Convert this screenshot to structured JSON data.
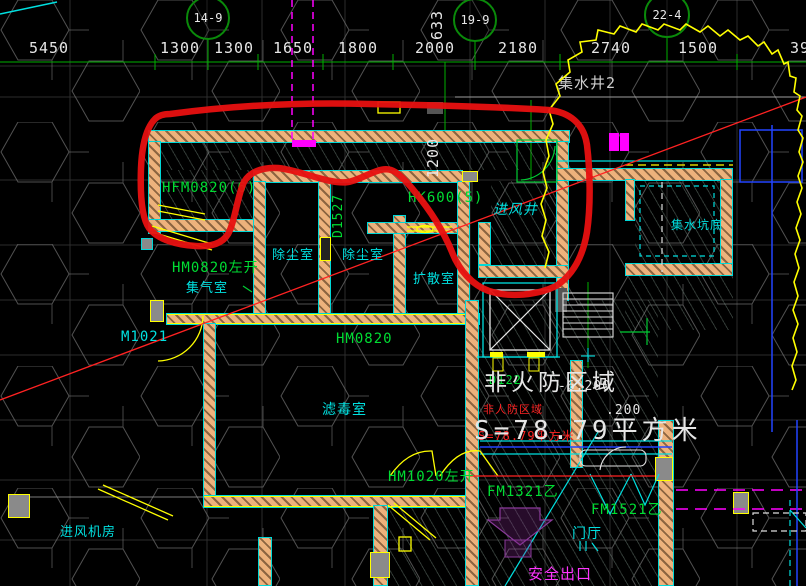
{
  "drawing": {
    "colors": {
      "background": "#000000",
      "wall": "#EDB27C",
      "wall_edge": "#00D8D8",
      "markup_red": "#E81010",
      "revision_cloud": "#FFFF00",
      "label_green": "#00DD33",
      "label_cyan": "#00E0E0",
      "label_magenta": "#FF35FF",
      "dim_white": "#E6E6E6",
      "grid_green": "#00B000"
    },
    "grid_bubbles": [
      {
        "name": "grid-bubble-14-9",
        "text": "14-9",
        "cx": 208,
        "cy": 18,
        "r": 20
      },
      {
        "name": "grid-bubble-19-9",
        "text": "19-9",
        "cx": 475,
        "cy": 20,
        "r": 20
      },
      {
        "name": "grid-bubble-22-4",
        "text": "22-4",
        "cx": 667,
        "cy": 15,
        "r": 21
      }
    ],
    "dimension_labels": [
      {
        "name": "dim-5450",
        "text": "5450",
        "x": 49,
        "y": 41
      },
      {
        "name": "dim-1300-a",
        "text": "1300",
        "x": 180,
        "y": 41
      },
      {
        "name": "dim-1300-b",
        "text": "1300",
        "x": 234,
        "y": 41
      },
      {
        "name": "dim-1650",
        "text": "1650",
        "x": 293,
        "y": 41
      },
      {
        "name": "dim-1800",
        "text": "1800",
        "x": 358,
        "y": 41
      },
      {
        "name": "dim-2000",
        "text": "2000",
        "x": 435,
        "y": 41
      },
      {
        "name": "dim-2180",
        "text": "2180",
        "x": 518,
        "y": 41
      },
      {
        "name": "dim-2740",
        "text": "2740",
        "x": 611,
        "y": 41
      },
      {
        "name": "dim-1500",
        "text": "1500",
        "x": 698,
        "y": 41
      },
      {
        "name": "dim-39",
        "text": "39",
        "x": 800,
        "y": 41
      }
    ],
    "vertical_dims": [
      {
        "name": "dim-633",
        "text": "633",
        "x": 430,
        "y": 40
      },
      {
        "name": "dim-1200",
        "text": "1200",
        "x": 426,
        "y": 178
      }
    ],
    "labels": [
      {
        "name": "door-tag-hfm0820",
        "text": "HFM0820(6)",
        "x": 162,
        "y": 181,
        "cls": "green",
        "size": 14
      },
      {
        "name": "door-tag-hm0820-leftopen",
        "text": "HM0820左开",
        "x": 172,
        "y": 261,
        "cls": "green",
        "size": 14
      },
      {
        "name": "room-gas-collection",
        "text": "集气室",
        "x": 186,
        "y": 282,
        "cls": "cyan",
        "size": 13
      },
      {
        "name": "room-dust-removal-1",
        "text": "除尘室",
        "x": 272,
        "y": 249,
        "cls": "cyan",
        "size": 13
      },
      {
        "name": "room-dust-removal-2",
        "text": "除尘室",
        "x": 342,
        "y": 249,
        "cls": "cyan",
        "size": 13
      },
      {
        "name": "damper-tag-d1527",
        "text": "D1527",
        "x": 332,
        "y": 238,
        "cls": "green vert",
        "size": 13
      },
      {
        "name": "damper-tag-hk600",
        "text": "HK600(5)",
        "x": 408,
        "y": 191,
        "cls": "green",
        "size": 14
      },
      {
        "name": "room-air-intake-shaft",
        "text": "进风井",
        "x": 494,
        "y": 203,
        "cls": "cyan italic",
        "size": 14
      },
      {
        "name": "room-diffusion",
        "text": "扩散室",
        "x": 413,
        "y": 273,
        "cls": "cyan",
        "size": 13
      },
      {
        "name": "room-sump-pit-bottom",
        "text": "集水坑底",
        "x": 671,
        "y": 219,
        "cls": "cyan",
        "size": 12
      },
      {
        "name": "label-sump-well-2",
        "text": "集水井2",
        "x": 558,
        "y": 76,
        "cls": "gray",
        "size": 15
      },
      {
        "name": "door-tag-m1021",
        "text": "M1021",
        "x": 121,
        "y": 330,
        "cls": "cyan",
        "size": 14
      },
      {
        "name": "door-tag-hm0820-b",
        "text": "HM0820",
        "x": 336,
        "y": 332,
        "cls": "green",
        "size": 14
      },
      {
        "name": "room-gas-filter",
        "text": "滤毒室",
        "x": 322,
        "y": 403,
        "cls": "cyan",
        "size": 14
      },
      {
        "name": "door-tag-hm1020-leftopen",
        "text": "HM1020左开",
        "x": 388,
        "y": 470,
        "cls": "green",
        "size": 14
      },
      {
        "name": "door-tag-fm1321",
        "text": "FM1321乙",
        "x": 487,
        "y": 485,
        "cls": "green",
        "size": 14
      },
      {
        "name": "door-tag-fm1521",
        "text": "FM1521乙",
        "x": 591,
        "y": 503,
        "cls": "green",
        "size": 14
      },
      {
        "name": "room-foyer",
        "text": "门厅",
        "x": 572,
        "y": 527,
        "cls": "cyan",
        "size": 14
      },
      {
        "name": "room-air-intake-fan",
        "text": "进风机房",
        "x": 60,
        "y": 526,
        "cls": "cyan",
        "size": 13
      },
      {
        "name": "label-safety-exit",
        "text": "安全出口",
        "x": 528,
        "y": 567,
        "cls": "magenta",
        "size": 15
      },
      {
        "name": "tag-d122",
        "text": "D122",
        "x": 489,
        "y": 374,
        "cls": "green",
        "size": 12
      },
      {
        "name": "note-non-defense-area-red",
        "text": "非人防区域",
        "x": 483,
        "y": 404,
        "cls": "red",
        "size": 11
      },
      {
        "name": "note-area-size-red",
        "text": "S=78.79平方米",
        "x": 478,
        "y": 430,
        "cls": "red",
        "size": 12
      },
      {
        "name": "title-zone",
        "text": "非火防区域",
        "x": 484,
        "y": 372,
        "cls": "white big",
        "size": 23
      },
      {
        "name": "elevation-minus-6200",
        "text": "-6.200",
        "x": 558,
        "y": 380,
        "cls": "white",
        "size": 13
      },
      {
        "name": "elevation-200",
        "text": ".200",
        "x": 606,
        "y": 404,
        "cls": "white",
        "size": 13
      },
      {
        "name": "title-zone-area",
        "text": "S=78.79平方米",
        "x": 474,
        "y": 418,
        "cls": "white big",
        "size": 26
      }
    ]
  }
}
